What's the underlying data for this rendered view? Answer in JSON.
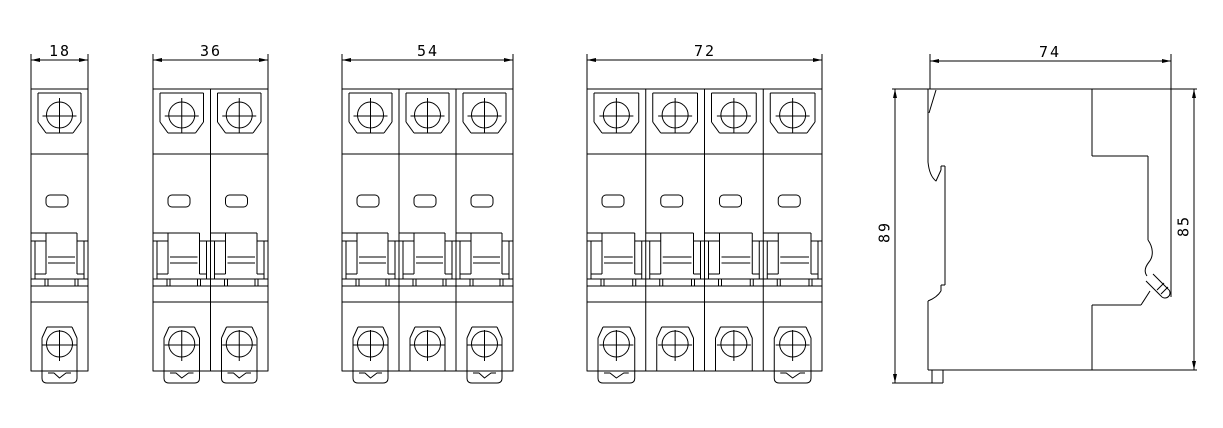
{
  "page": {
    "background": "#ffffff",
    "line_color": "#000000",
    "text_color": "#000000"
  },
  "drawing": {
    "type": "engineering-dimension-drawing",
    "subject": "din-rail-miniature-circuit-breakers",
    "front_views": [
      {
        "id": "breaker-1-pole",
        "poles": 1,
        "width_label": "18",
        "x": 31,
        "width": 57
      },
      {
        "id": "breaker-2-pole",
        "poles": 2,
        "width_label": "36",
        "x": 153,
        "width": 115
      },
      {
        "id": "breaker-3-pole",
        "poles": 3,
        "width_label": "54",
        "x": 342,
        "width": 171
      },
      {
        "id": "breaker-4-pole",
        "poles": 4,
        "width_label": "72",
        "x": 587,
        "width": 235
      }
    ],
    "side_view": {
      "id": "breaker-side-view",
      "width_label": "74",
      "height_label_left": "89",
      "height_label_right": "85"
    }
  }
}
